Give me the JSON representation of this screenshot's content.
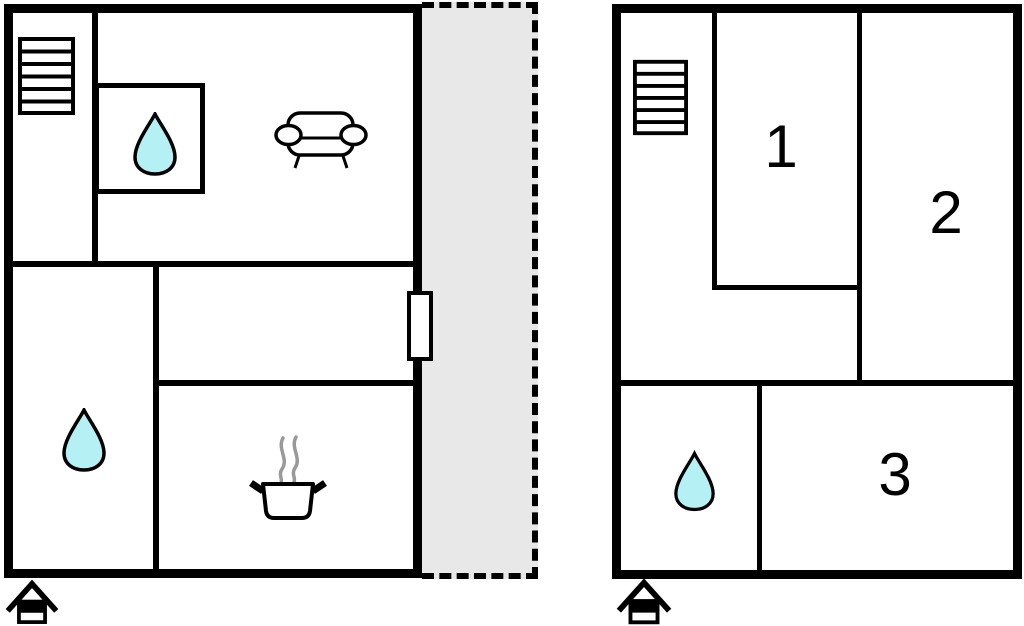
{
  "diagram": {
    "type": "floor-plan",
    "units_count": 2
  },
  "colors": {
    "wall": "#000000",
    "water_drop_fill": "#b5f0f4",
    "terrace_fill": "#e8e8e8",
    "steam": "#999999",
    "background": "#ffffff"
  },
  "left_unit": {
    "icons": {
      "stairs": "stairs-icon",
      "bathroom_upper_drop": "water-drop-icon",
      "sofa": "sofa-icon",
      "bathroom_lower_drop": "water-drop-icon",
      "cooking_pot": "cooking-pot-icon",
      "terrace_door": "door-icon",
      "entrance": "house-entrance-icon"
    }
  },
  "right_unit": {
    "room_labels": [
      "1",
      "2",
      "3"
    ],
    "icons": {
      "stairs": "stairs-icon",
      "bathroom_drop": "water-drop-icon",
      "entrance": "house-entrance-icon"
    }
  }
}
